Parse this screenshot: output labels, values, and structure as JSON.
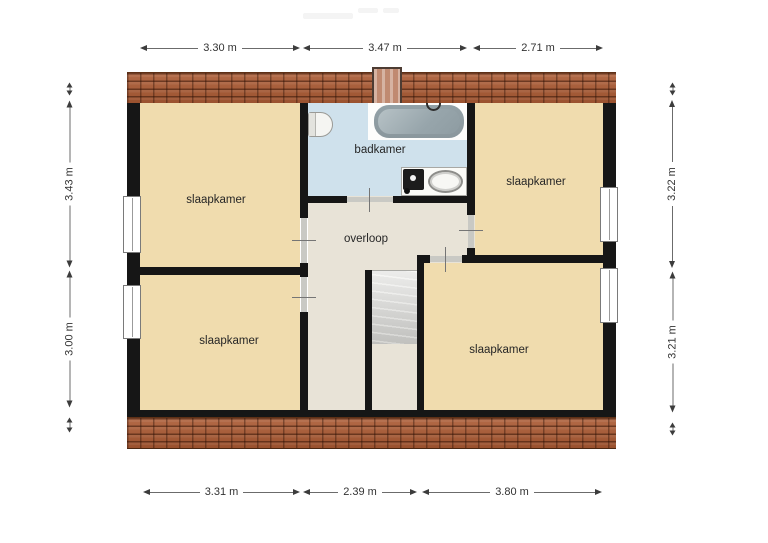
{
  "rooms": {
    "slaapkamer_tl": {
      "label": "slaapkamer"
    },
    "slaapkamer_tr": {
      "label": "slaapkamer"
    },
    "slaapkamer_bl": {
      "label": "slaapkamer"
    },
    "slaapkamer_br": {
      "label": "slaapkamer"
    },
    "badkamer": {
      "label": "badkamer"
    },
    "overloop": {
      "label": "overloop"
    }
  },
  "dimensions": {
    "top": [
      {
        "label": "3.30 m"
      },
      {
        "label": "3.47 m"
      },
      {
        "label": "2.71 m"
      }
    ],
    "bottom": [
      {
        "label": "3.31 m"
      },
      {
        "label": "2.39 m"
      },
      {
        "label": "3.80 m"
      }
    ],
    "left": [
      {
        "label": "3.43 m"
      },
      {
        "label": "3.00 m"
      }
    ],
    "right": [
      {
        "label": "3.22 m"
      },
      {
        "label": "3.21 m"
      }
    ]
  },
  "colors": {
    "floor-beige": "#f0dcae",
    "floor-gray": "#e8e3d7",
    "bathroom-blue": "#cfe1ec",
    "wall-black": "#161616",
    "roof-brick": "#ab5a33",
    "stairs-gray": "#d6d6d3",
    "dimension-text": "#333333"
  }
}
